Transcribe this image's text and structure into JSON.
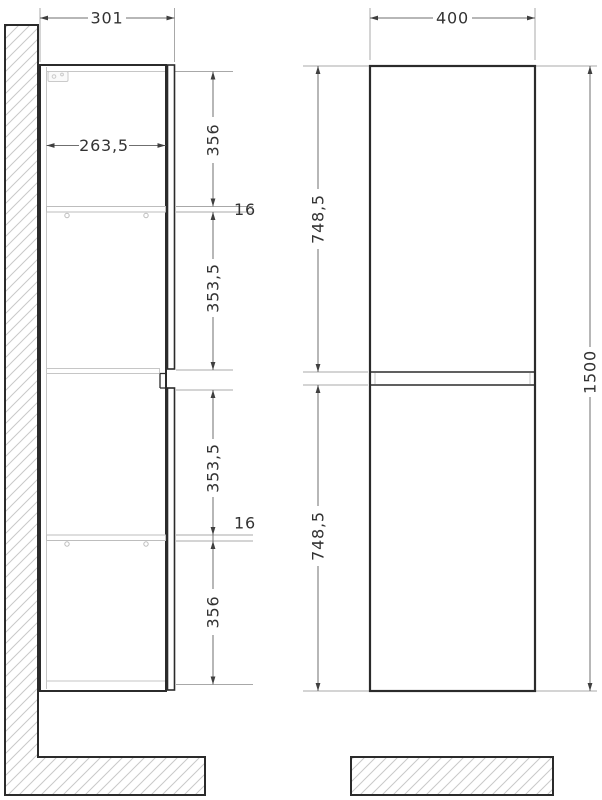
{
  "drawing": {
    "side_view": {
      "overall_depth": "301",
      "interior_depth": "263,5",
      "top_section": "356",
      "shelf_thickness_upper": "16",
      "mid_upper_section": "353,5",
      "mid_lower_section": "353,5",
      "shelf_thickness_lower": "16",
      "bottom_section": "356"
    },
    "front_view": {
      "overall_width": "400",
      "upper_door_height": "748,5",
      "lower_door_height": "748,5",
      "overall_height": "1500"
    },
    "colors": {
      "outline": "#2b2b2b",
      "dimension_line": "#6f6f6f",
      "extension_line": "#a8a8a8",
      "hatch": "#c9c9c9",
      "light_detail": "#c6c6c6",
      "text": "#333333",
      "background": "#ffffff"
    }
  }
}
